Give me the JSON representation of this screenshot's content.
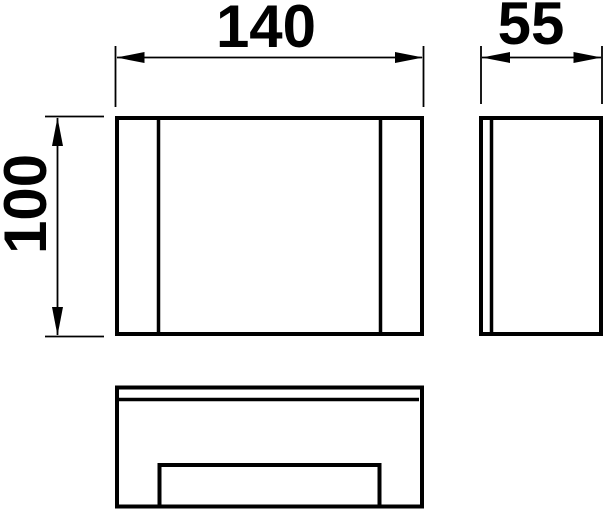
{
  "drawing": {
    "title": "product-dimension-drawing",
    "dimensions": {
      "width_label": "140",
      "depth_label": "55",
      "height_label": "100"
    },
    "colors": {
      "line": "#000000",
      "background": "#ffffff"
    }
  }
}
